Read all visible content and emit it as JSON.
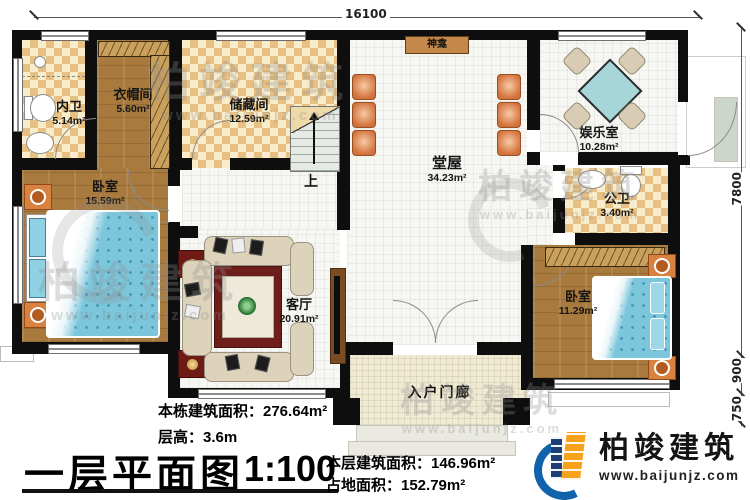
{
  "plan": {
    "dimensions": {
      "top": "16100",
      "right_upper": "7800",
      "right_middle": "900",
      "right_lower": "750"
    },
    "rooms": {
      "neiwei": {
        "name": "内卫",
        "area": "5.14m²"
      },
      "yimaojian": {
        "name": "衣帽间",
        "area": "5.60m²"
      },
      "chucangjian": {
        "name": "储藏间",
        "area": "12.59m²"
      },
      "tangwu": {
        "name": "堂屋",
        "area": "34.23m²"
      },
      "yuleshi": {
        "name": "娱乐室",
        "area": "10.28m²"
      },
      "gongwei": {
        "name": "公卫",
        "area": "3.40m²"
      },
      "woshi_left": {
        "name": "卧室",
        "area": "15.59m²"
      },
      "keting": {
        "name": "客厅",
        "area": "20.91m²"
      },
      "woshi_right": {
        "name": "卧室",
        "area": "11.29m²"
      },
      "rumenlang": {
        "name": "入户门廊"
      }
    },
    "markers": {
      "shrine": "神龛",
      "stairs_up": "上"
    }
  },
  "title_block": {
    "building_total_area": "本栋建筑面积：276.64m²",
    "floor_height": "层高：3.6m",
    "title": "一层平面图",
    "scale": "1:100",
    "floor_area": "本层建筑面积：146.96m²",
    "land_area": "占地面积：152.79m²"
  },
  "brand": {
    "name": "柏竣建筑",
    "website": "www.baijunjz.com"
  },
  "colors": {
    "wall": "#0e0e0e",
    "checker_floor": "#e7c183",
    "wood_floor": "#a97a3d",
    "tile_floor": "#f6f6f3",
    "bed": "#7cc6dc",
    "brand_blue": "#1062ab",
    "brand_orange": "#f7a21b"
  }
}
